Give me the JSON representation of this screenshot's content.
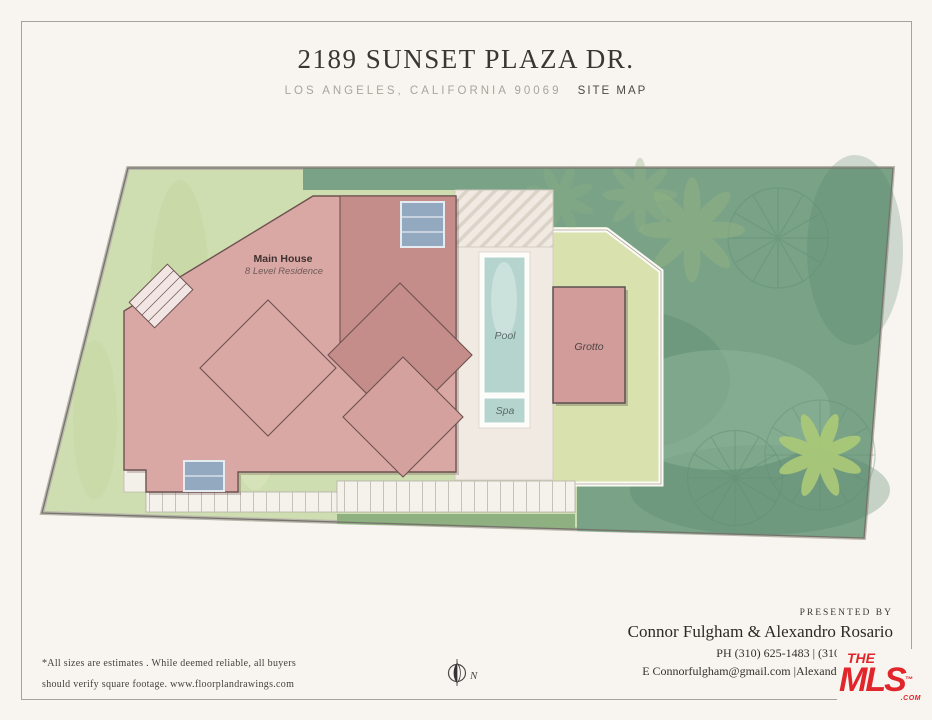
{
  "header": {
    "title": "2189 SUNSET PLAZA DR.",
    "location": "LOS ANGELES, CALIFORNIA  90069",
    "map_type": "SITE MAP"
  },
  "plan": {
    "main_house_label": "Main House",
    "main_house_sublabel": "8 Level Residence",
    "pool_label": "Pool",
    "spa_label": "Spa",
    "grotto_label": "Grotto",
    "compass_label": "N"
  },
  "footer": {
    "disclaimer_line1": "*All sizes are estimates . While deemed reliable, all buyers",
    "disclaimer_line2": "should verify square footage.   www.floorplandrawings.com",
    "presented_by": "PRESENTED BY",
    "agents": "Connor Fulgham & Alexandro Rosario",
    "phone_line": "PH  (310) 625-1483 |  (310) 592-1259",
    "email_line": "E Connorfulgham@gmail.com |Alexandro4242@ya"
  },
  "logo": {
    "the": "THE",
    "mls": "MLS",
    "tm": "™",
    "com": ".COM"
  },
  "colors": {
    "page_bg": "#f8f4ef",
    "lawn": "#cfdeb0",
    "foliage": "#79a287",
    "house_light": "#d9a8a5",
    "house_mid": "#d5a19e",
    "house_dark": "#c48d8a",
    "deck": "#f0eae2",
    "walkway": "#f5f2ec",
    "pool_water": "#b4d4cd",
    "grotto": "#d29c9b",
    "grotto_pad": "#d9e2ae",
    "panel_blue": "#93a9bf",
    "grass_strip": "#8fb080",
    "mls_red": "#e0252b"
  }
}
